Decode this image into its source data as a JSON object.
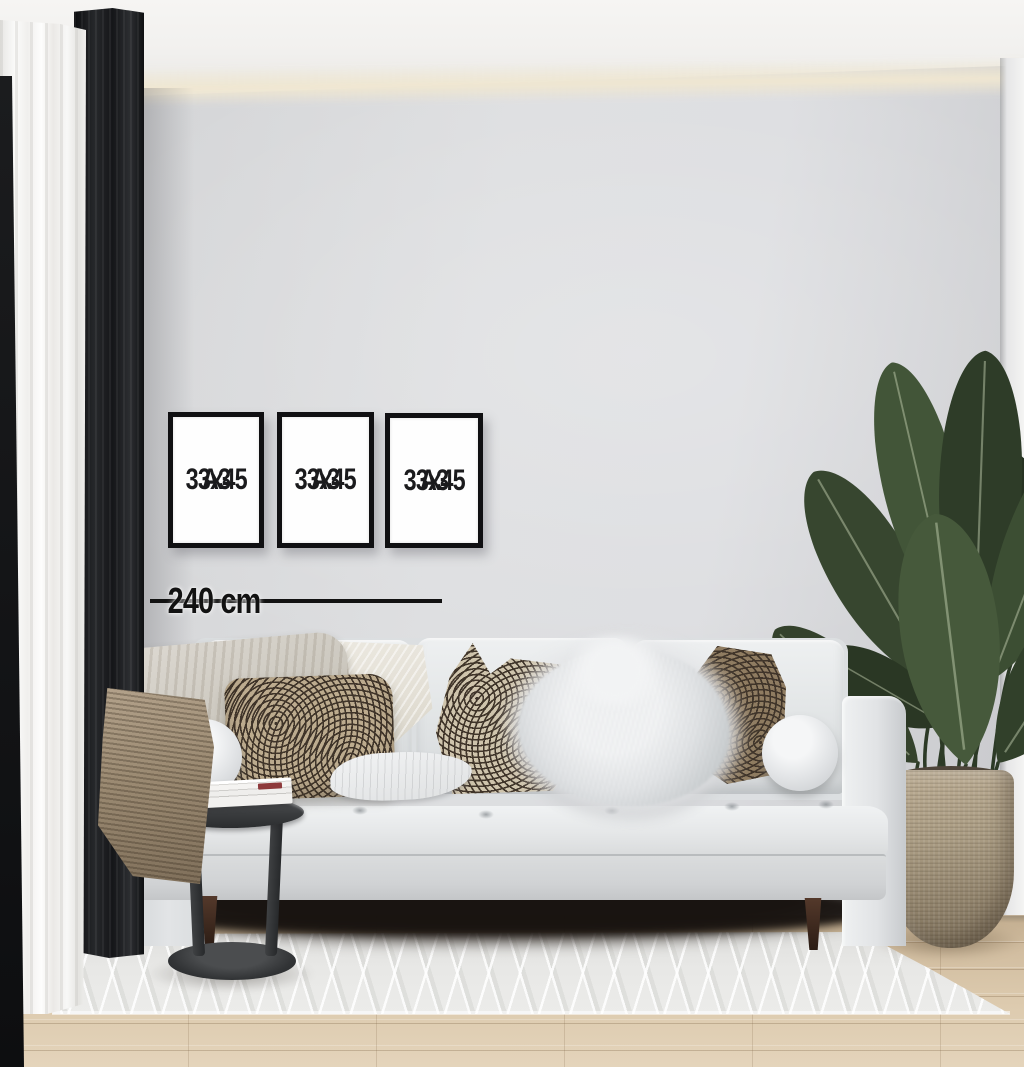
{
  "frames": {
    "items": [
      {
        "size": "33x45",
        "format": "A3"
      },
      {
        "size": "33x45",
        "format": "A3"
      },
      {
        "size": "33x45",
        "format": "A3"
      }
    ]
  },
  "measurement": {
    "label": "240 cm"
  },
  "palette": {
    "wall": "#dcdde0",
    "ceiling": "#f4f3f1",
    "cove_glow": "#f0e7d1",
    "frame_border": "#101012",
    "frame_text": "#1b1b1d",
    "measure_line": "#121212",
    "sofa": "#e4e6e8",
    "curtain_dark": "#17181b",
    "curtain_sheer": "#f4f3f1",
    "floor_wood": "#d6c3a6",
    "rug": "#e6e6e4",
    "leaf_green": "#3a4c33",
    "pot_woven": "#a89a81",
    "side_table": "#3a3c3e",
    "pillow_tan": "#bcab8e",
    "pillow_brown": "#8f7c61",
    "blanket_taupe": "#9a8971"
  }
}
